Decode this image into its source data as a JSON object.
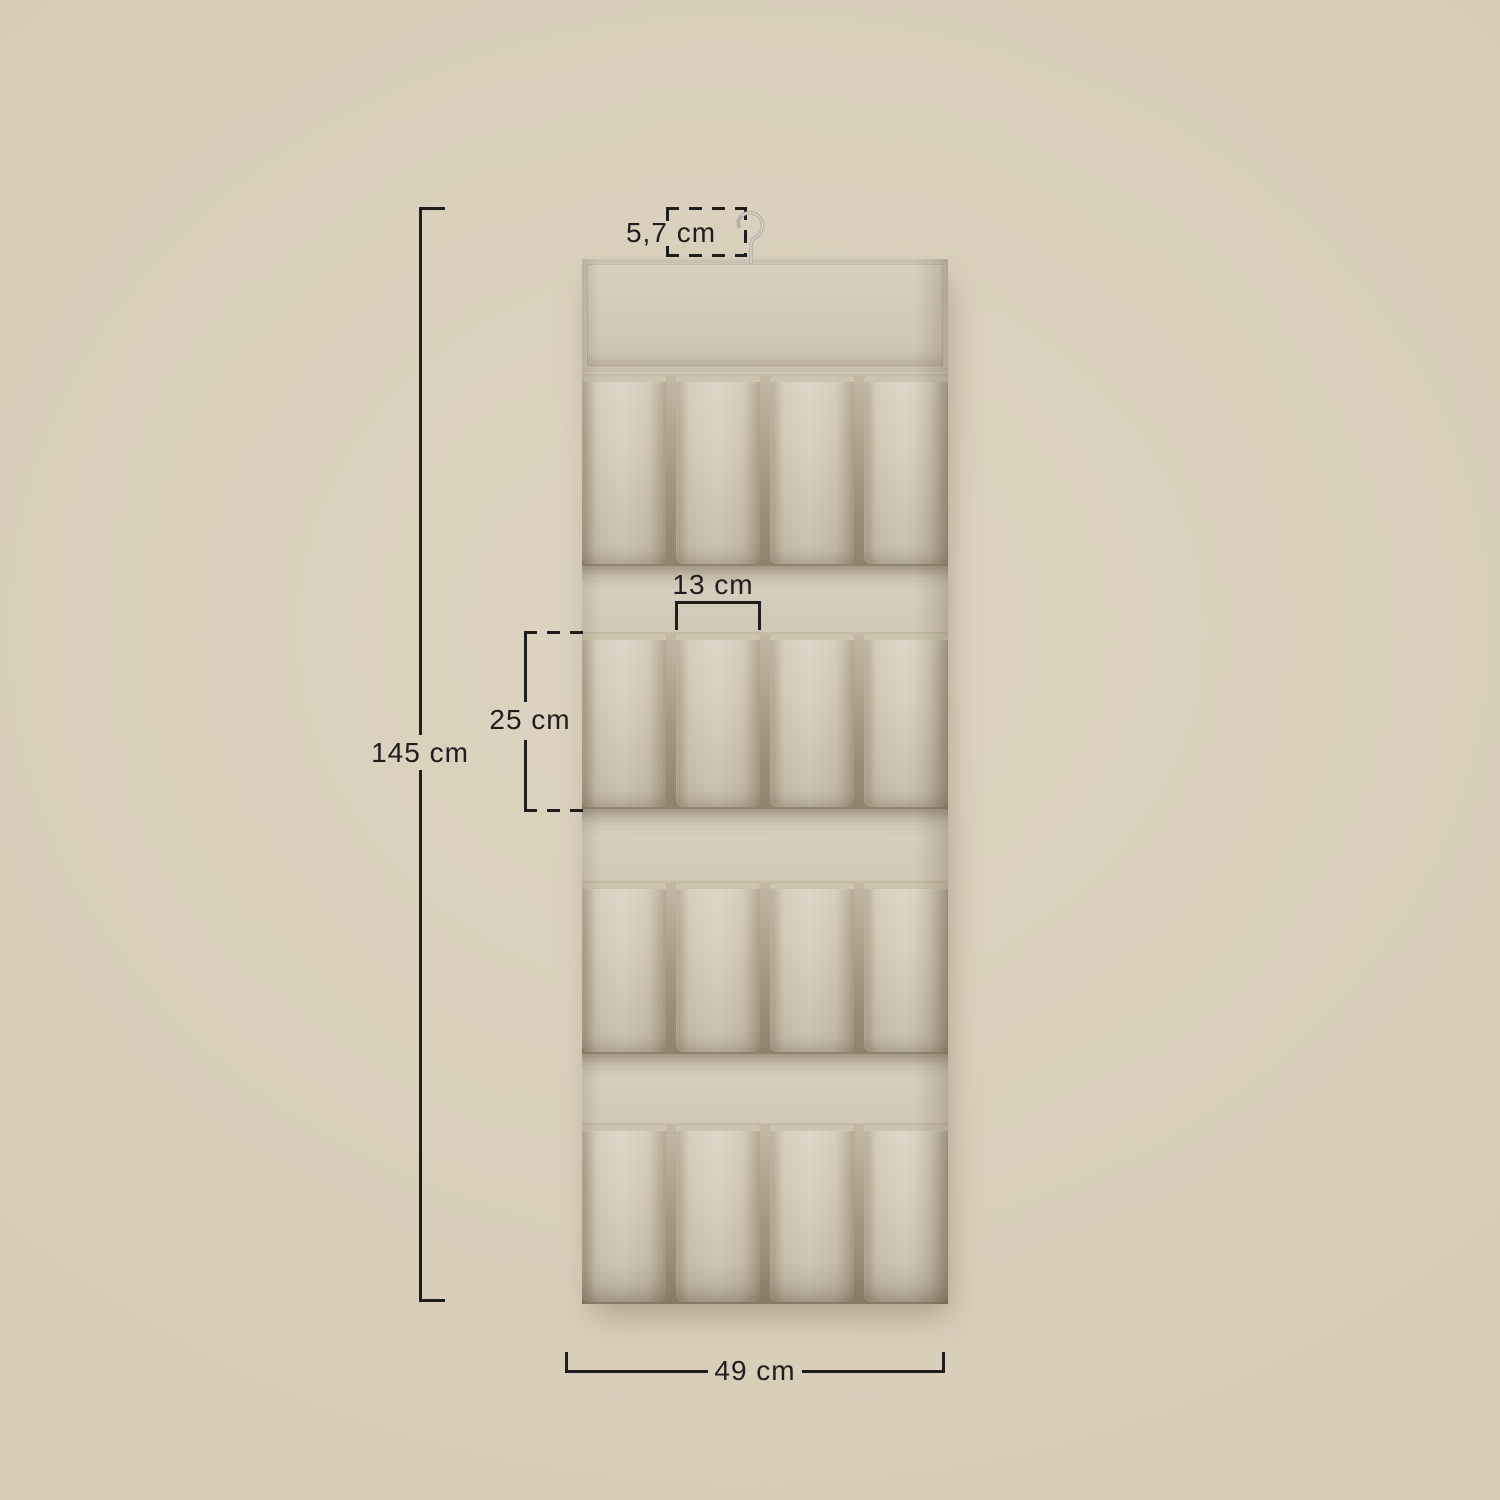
{
  "scene": {
    "description": "Product dimension diagram of a beige hanging fabric organizer with a metal hook and four rows of four open pockets",
    "background_color": "#d7cdb9"
  },
  "organizer": {
    "rows": 4,
    "pockets_per_row": 4,
    "fabric_color": "#d5cbb8",
    "trim_color": "#cec6b0",
    "crease_color": "#8e806a",
    "hook_color": "#b4b0a8"
  },
  "annotations": {
    "line_color": "#1f1e1c",
    "hook_width_label": "5,7 cm",
    "pocket_width_label": "13 cm",
    "pocket_height_label": "25 cm",
    "total_height_label": "145 cm",
    "total_width_label": "49 cm"
  }
}
